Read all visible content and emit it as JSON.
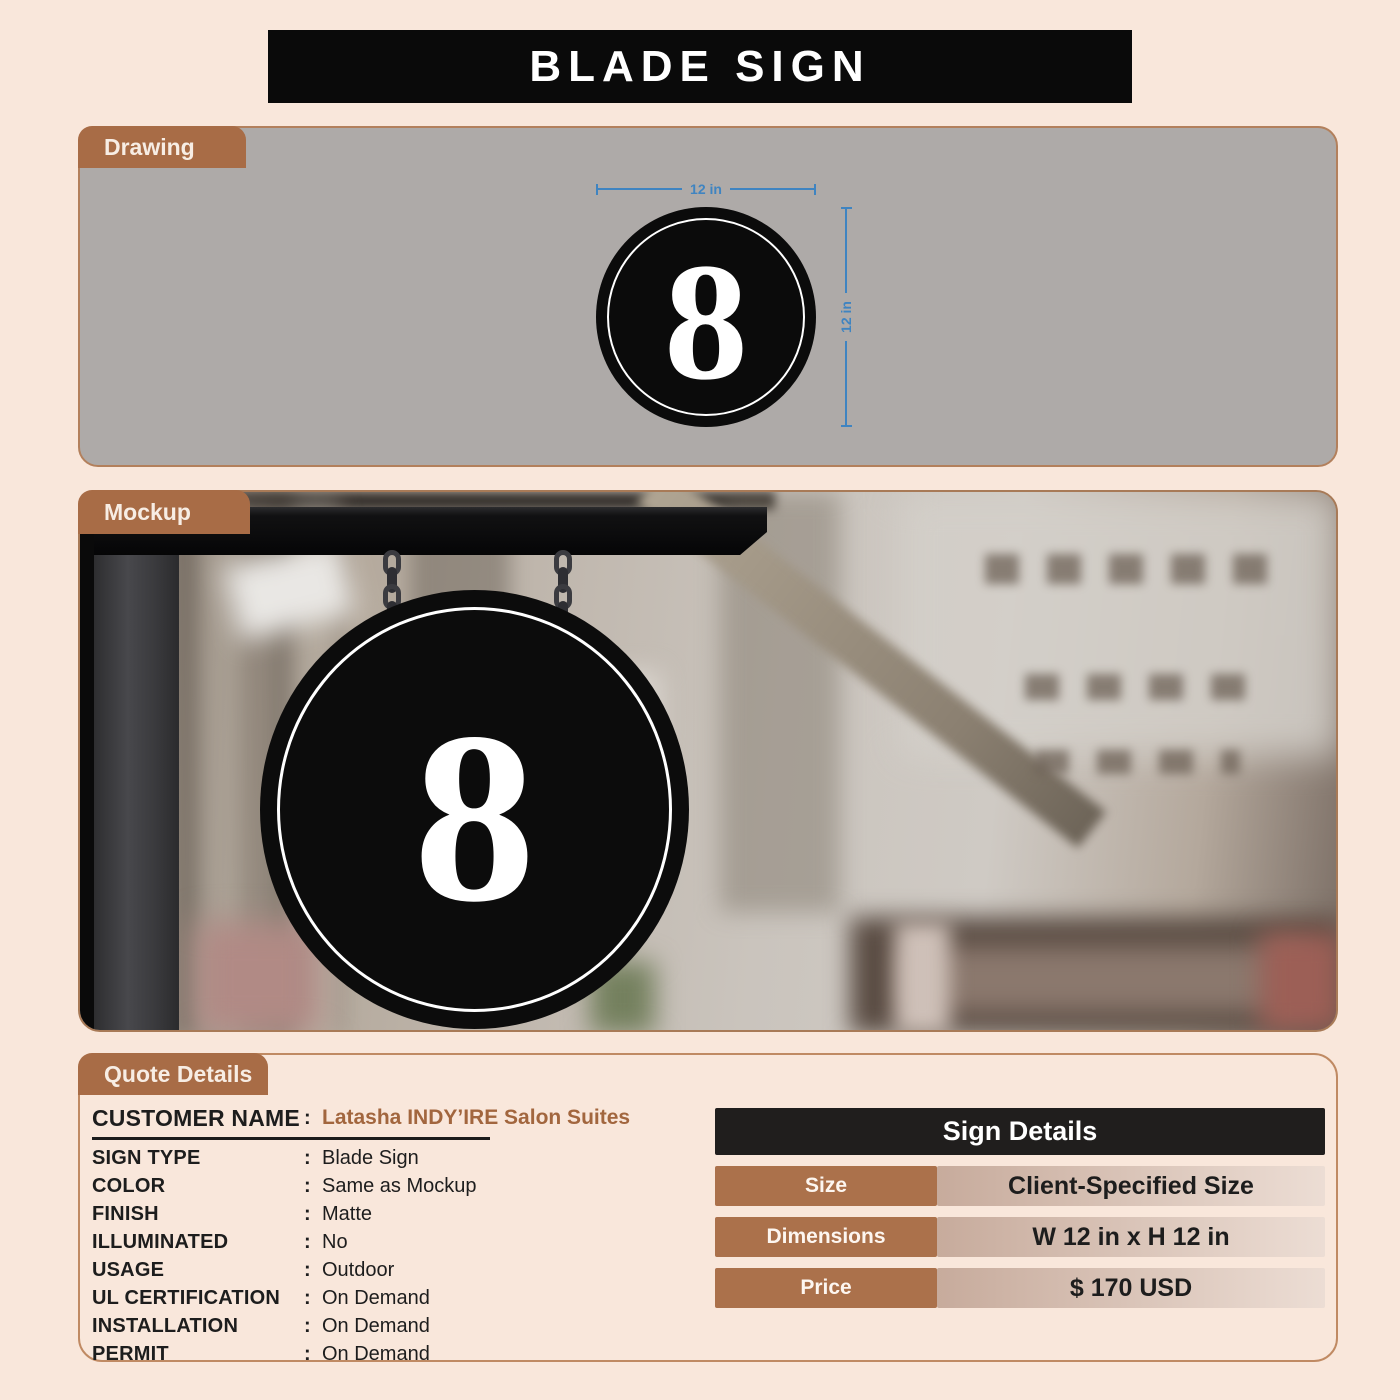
{
  "title": "BLADE SIGN",
  "drawing": {
    "tab_label": "Drawing",
    "sign_text": "8",
    "width_label": "12 in",
    "height_label": "12 in"
  },
  "mockup": {
    "tab_label": "Mockup",
    "sign_text": "8"
  },
  "quote": {
    "tab_label": "Quote Details",
    "colon": ":",
    "fields": [
      {
        "label": "CUSTOMER NAME",
        "value": "Latasha INDY’IRE Salon Suites"
      },
      {
        "label": "SIGN TYPE",
        "value": "Blade Sign"
      },
      {
        "label": "COLOR",
        "value": "Same as Mockup"
      },
      {
        "label": "FINISH",
        "value": "Matte"
      },
      {
        "label": "ILLUMINATED",
        "value": "No"
      },
      {
        "label": "USAGE",
        "value": "Outdoor"
      },
      {
        "label": "UL CERTIFICATION",
        "value": "On Demand"
      },
      {
        "label": "INSTALLATION",
        "value": "On Demand"
      },
      {
        "label": "PERMIT",
        "value": "On Demand"
      }
    ]
  },
  "sign_details": {
    "header": "Sign Details",
    "rows": [
      {
        "label": "Size",
        "value": "Client-Specified Size"
      },
      {
        "label": "Dimensions",
        "value": "W 12 in x H 12 in"
      },
      {
        "label": "Price",
        "value": "$ 170 USD"
      }
    ]
  },
  "colors": {
    "page_background": "#f9e7db",
    "banner_black": "#0a0a0a",
    "tab_brown": "#a86c46",
    "drawing_gray": "#aeaaa8",
    "dimension_blue": "#3f84c1",
    "customer_value_brown": "#a2663e",
    "table_label_brown": "#ab714b",
    "table_value_gradient": [
      "#c7ab9c",
      "#ecddd4"
    ],
    "sign_black": "#0c0c0c",
    "sign_ring_white": "#ffffff"
  }
}
